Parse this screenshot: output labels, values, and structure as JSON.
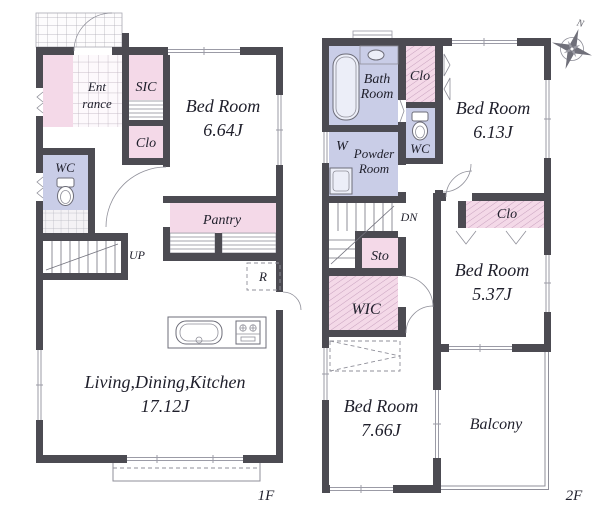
{
  "colors": {
    "wall": "#4c4b52",
    "room_pink": "#f4d9e8",
    "room_lavender": "#c9cde7",
    "thin_line": "#8f8f99",
    "text": "#1f1f2b"
  },
  "floor1": {
    "label": "1F",
    "entrance": {
      "line1": "Ent",
      "line2": "rance"
    },
    "sic": {
      "label": "SIC"
    },
    "closet": {
      "label": "Clo"
    },
    "bedroom": {
      "name": "Bed Room",
      "size": "6.64J"
    },
    "wc": {
      "label": "WC"
    },
    "stairs": {
      "label": "UP"
    },
    "pantry": {
      "label": "Pantry"
    },
    "fridge": {
      "label": "R"
    },
    "ldk": {
      "name": "Living,Dining,Kitchen",
      "size": "17.12J"
    }
  },
  "floor2": {
    "label": "2F",
    "bath": {
      "line1": "Bath",
      "line2": "Room"
    },
    "closet_top": {
      "label": "Clo"
    },
    "bedroom_a": {
      "name": "Bed Room",
      "size": "6.13J"
    },
    "washer": {
      "label": "W"
    },
    "powder": {
      "line1": "Powder",
      "line2": "Room"
    },
    "wc": {
      "label": "WC"
    },
    "stairs": {
      "label": "DN"
    },
    "storage": {
      "label": "Sto"
    },
    "wic": {
      "label": "WIC"
    },
    "closet_mid": {
      "label": "Clo"
    },
    "bedroom_b": {
      "name": "Bed Room",
      "size": "5.37J"
    },
    "bedroom_c": {
      "name": "Bed Room",
      "size": "7.66J"
    },
    "balcony": {
      "label": "Balcony"
    },
    "compass": {
      "label": "N"
    }
  }
}
